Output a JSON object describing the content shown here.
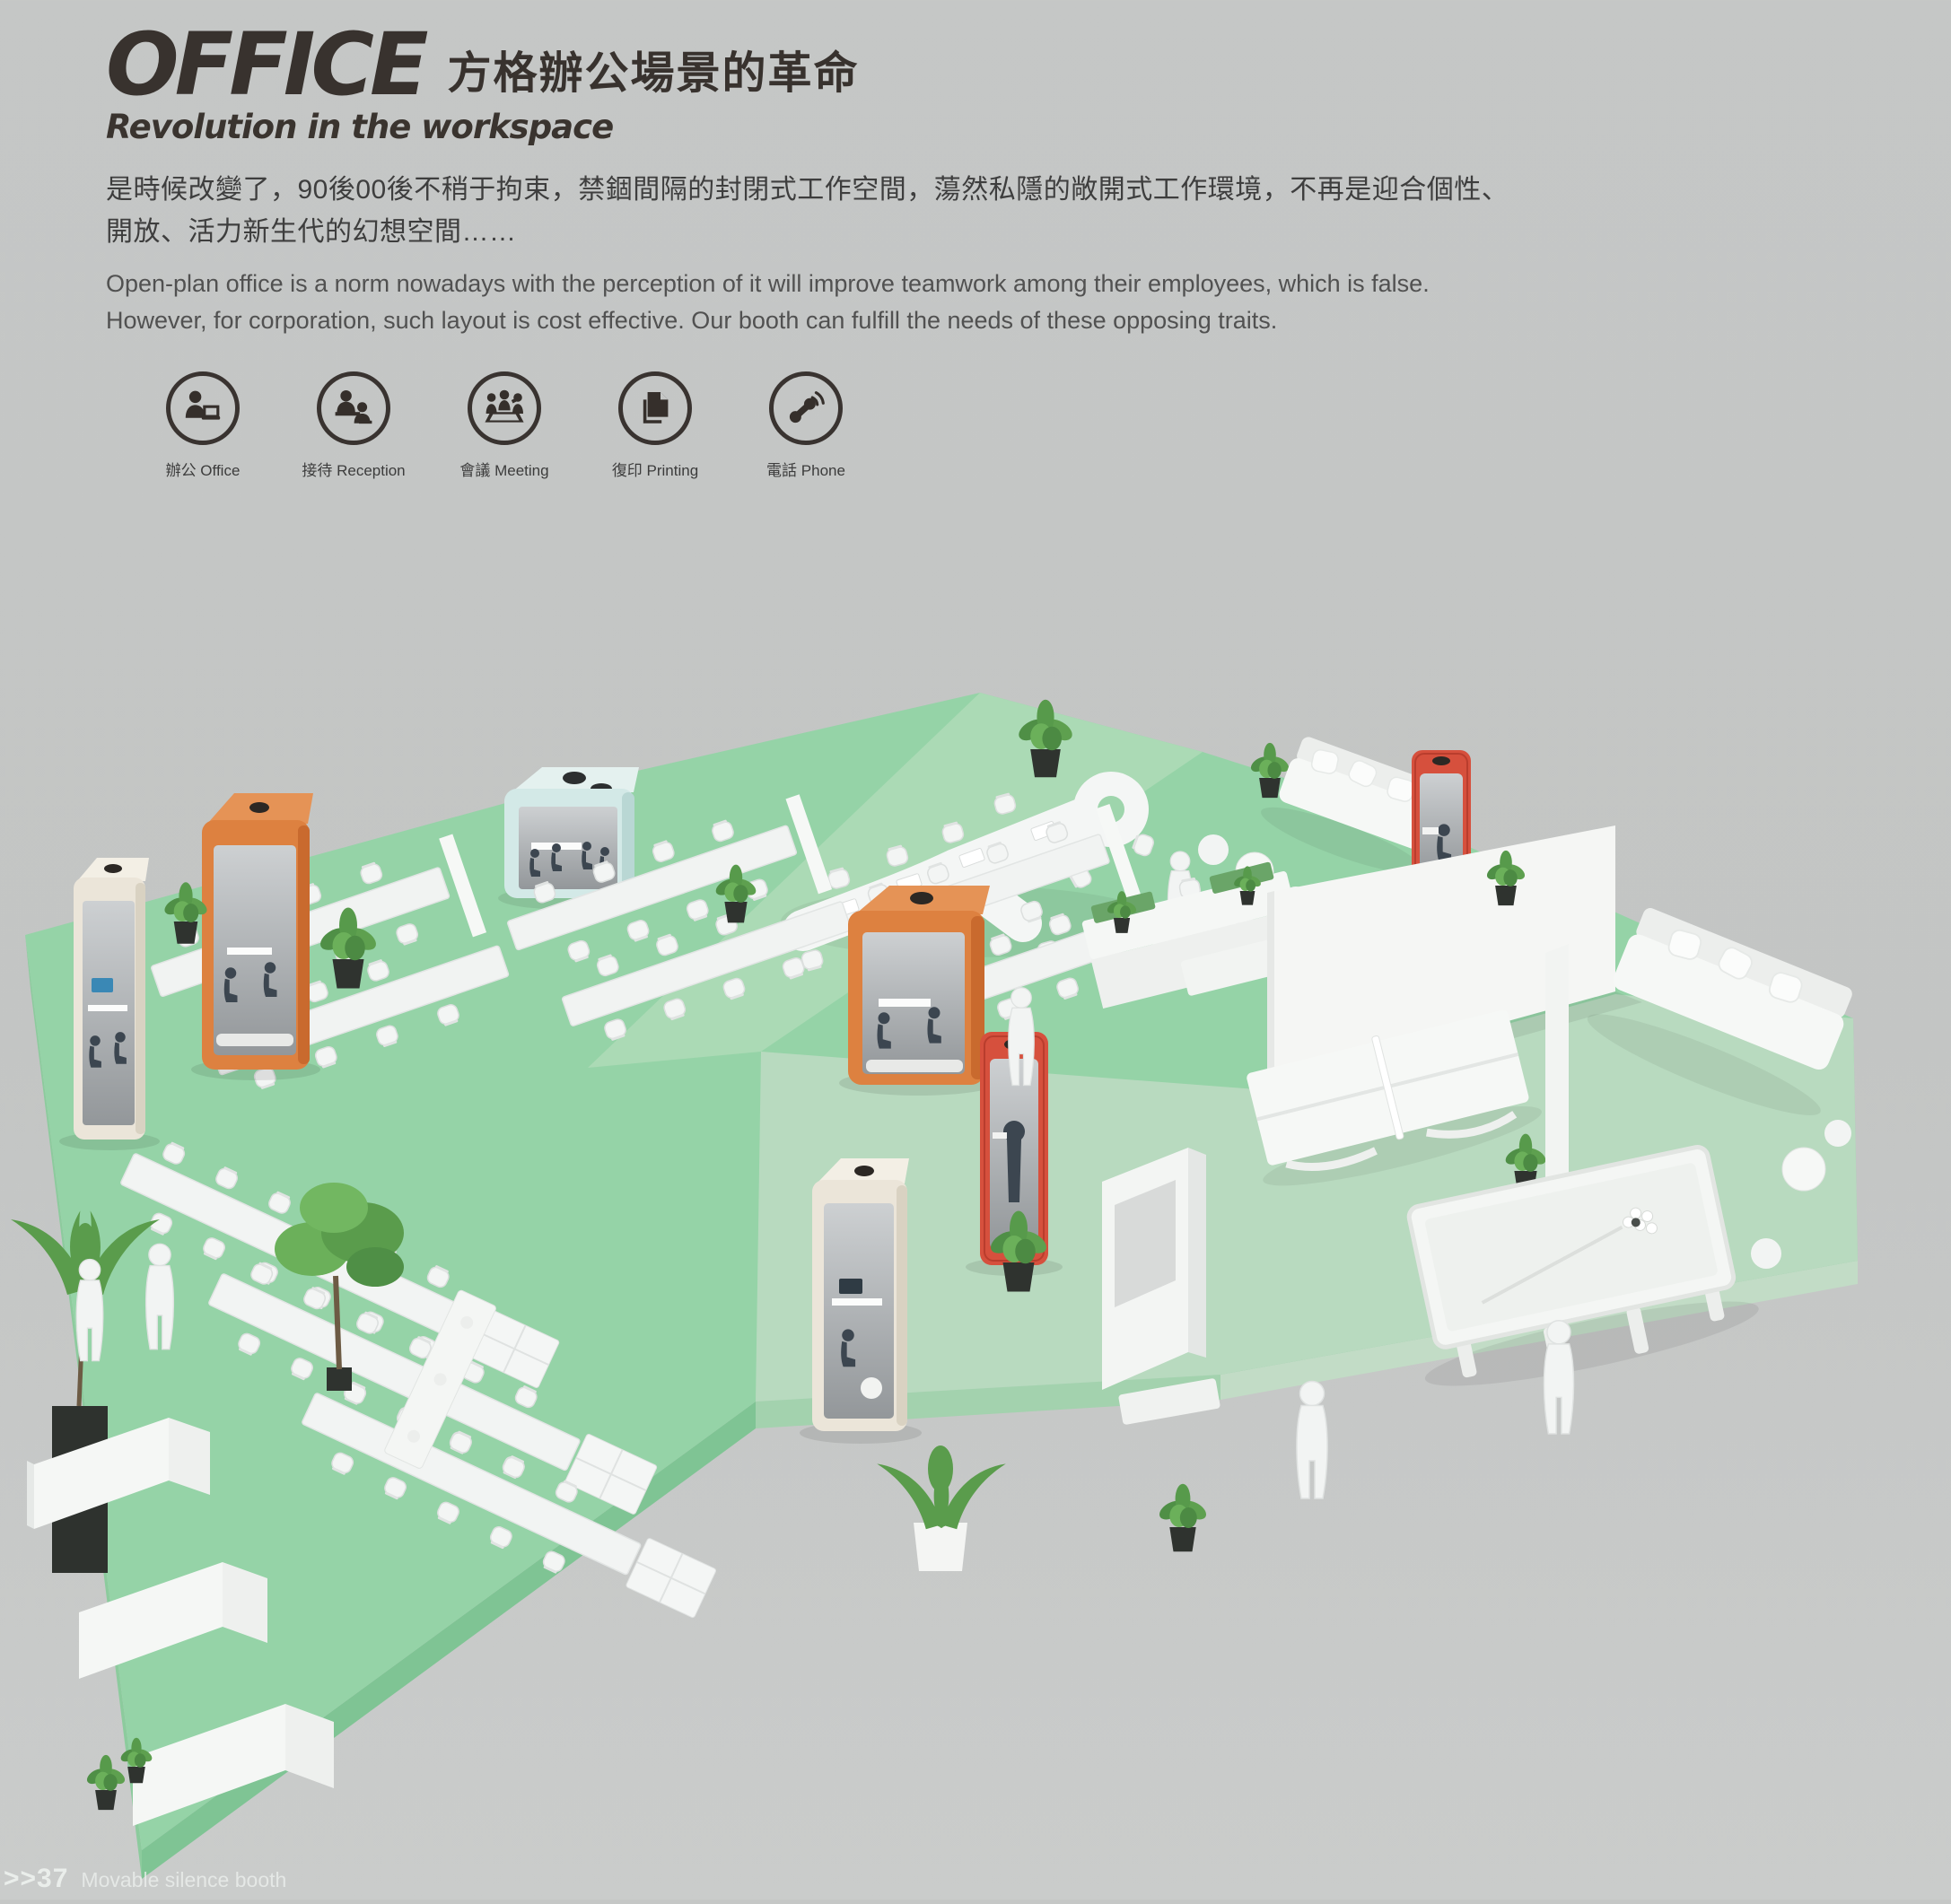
{
  "header": {
    "title_en": "OFFICE",
    "title_zh": "方格辦公場景的革命",
    "subtitle": "Revolution in the workspace",
    "intro_zh": [
      "是時候改變了，90後00後不稍于拘束，禁錮間隔的封閉式工作空間，蕩然私隱的敞開式工作環境，不再是迎合個性、",
      "開放、活力新生代的幻想空間……"
    ],
    "intro_en": [
      "Open-plan office is a norm nowadays with the perception of it will improve teamwork among their employees, which is false.",
      "However, for corporation, such layout is cost effective. Our booth can fulfill the needs of these opposing traits."
    ]
  },
  "features": [
    {
      "icon": "office-person-laptop-icon",
      "label": "辦公 Office"
    },
    {
      "icon": "reception-people-icon",
      "label": "接待 Reception"
    },
    {
      "icon": "meeting-group-icon",
      "label": "會議 Meeting"
    },
    {
      "icon": "printing-documents-icon",
      "label": "復印 Printing"
    },
    {
      "icon": "phone-handset-icon",
      "label": "電話 Phone"
    }
  ],
  "footer": {
    "page_marker": ">>37",
    "caption": "Movable silence booth"
  },
  "scene": {
    "description": "Isometric 3D render of an open-plan office exhibition floor with movable silence booths",
    "floor_colors": {
      "mint": "#95d3a7",
      "walkway": "#abdab5",
      "sage": "#b8dabf",
      "front_edge": "#7fc494"
    },
    "booths": [
      {
        "name": "white-duo-booth-left",
        "color": "#ebe5d9"
      },
      {
        "name": "orange-meeting-booth-left",
        "color": "#dd8140"
      },
      {
        "name": "blue-meeting-cube",
        "color": "#d3e9e7"
      },
      {
        "name": "orange-meeting-booth-center",
        "color": "#dd8140"
      },
      {
        "name": "red-phone-booth-center",
        "color": "#d6503d"
      },
      {
        "name": "white-solo-booth-center",
        "color": "#ebe5d9"
      },
      {
        "name": "red-phone-booth-right",
        "color": "#d6503d"
      }
    ],
    "zones": [
      "open-desk-area",
      "conference-table-area",
      "reception-counters",
      "lounge",
      "games-area",
      "cubicle-area"
    ]
  }
}
